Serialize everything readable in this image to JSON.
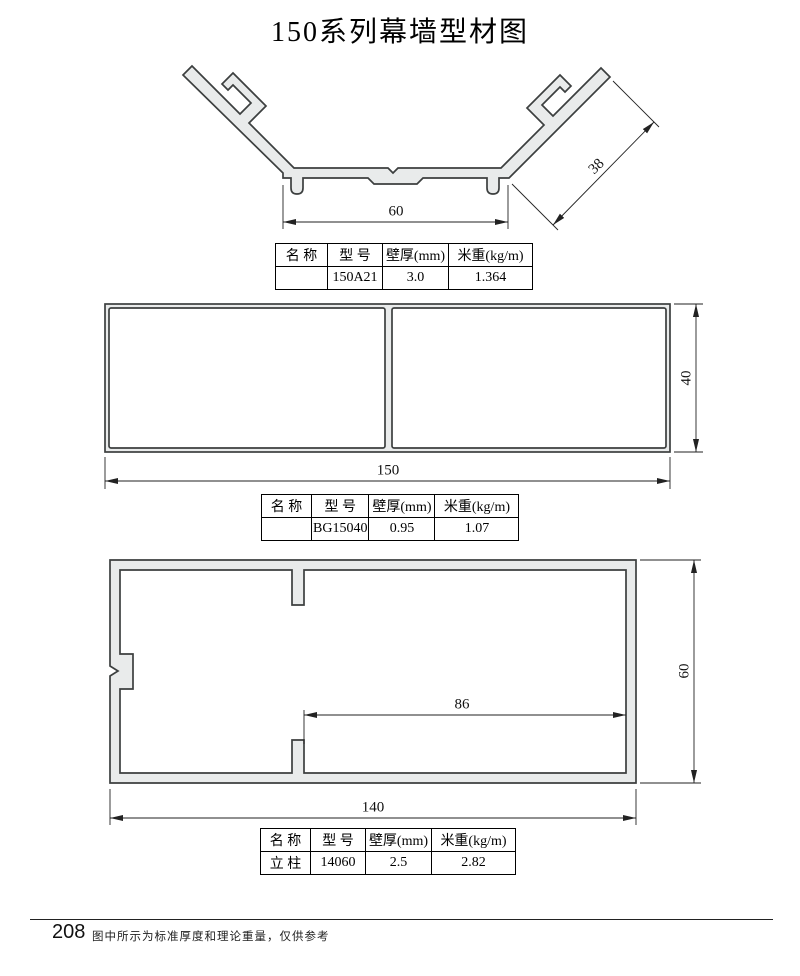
{
  "title": "150系列幕墙型材图",
  "profile1": {
    "dims": {
      "width": "60",
      "flange": "38"
    },
    "table": {
      "headers": [
        "名 称",
        "型 号",
        "壁厚(mm)",
        "米重(kg/m)"
      ],
      "row": [
        "",
        "150A21",
        "3.0",
        "1.364"
      ]
    }
  },
  "profile2": {
    "dims": {
      "width": "150",
      "height": "40"
    },
    "table": {
      "headers": [
        "名 称",
        "型 号",
        "壁厚(mm)",
        "米重(kg/m)"
      ],
      "row": [
        "",
        "BG15040",
        "0.95",
        "1.07"
      ]
    }
  },
  "profile3": {
    "dims": {
      "width": "140",
      "height": "60",
      "inner": "86"
    },
    "table": {
      "headers": [
        "名 称",
        "型 号",
        "壁厚(mm)",
        "米重(kg/m)"
      ],
      "row": [
        "立 柱",
        "14060",
        "2.5",
        "2.82"
      ]
    }
  },
  "footer": {
    "page_number": "208",
    "note": "图中所示为标准厚度和理论重量，仅供参考"
  }
}
